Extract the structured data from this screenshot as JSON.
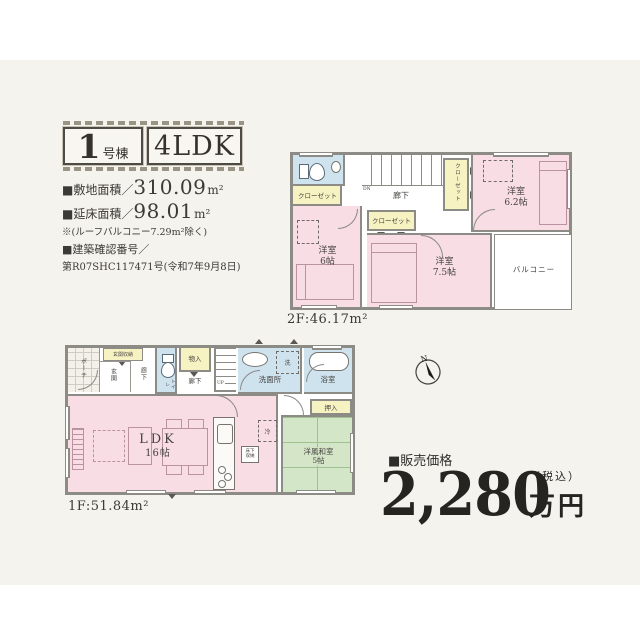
{
  "header": {
    "unit_big": "1",
    "unit_small": "号棟",
    "plan": "4LDK"
  },
  "specs": {
    "site_label": "■敷地面積／",
    "site_value": "310.09",
    "site_unit": "m²",
    "bldg_label": "■延床面積／",
    "bldg_value": "98.01",
    "bldg_unit": "m²",
    "note": "※(ルーフバルコニー7.29m²除く)",
    "permit_label": "■建築確認番号／",
    "permit_number": "第R07SHC117471号(令和7年9月8日)"
  },
  "floor2": {
    "area": "2F:46.17m²",
    "hallway": "廊下",
    "stairs": "DN",
    "closet_left": "クローゼット",
    "closet_mid": "クローゼット",
    "closet_right": "クローゼット",
    "room6_name": "洋室",
    "room6_size": "6帖",
    "room75_name": "洋室",
    "room75_size": "7.5帖",
    "room62_name": "洋室",
    "room62_size": "6.2帖",
    "balcony": "バルコニー"
  },
  "floor1": {
    "area": "1F:51.84m²",
    "porch": "ポーチ",
    "shoe": "玄関収納",
    "entrance": "玄関",
    "hall_front": "廊下",
    "toilet": "トイレ",
    "storage": "物入",
    "hallway": "廊下",
    "stairs": "UP",
    "washroom": "洗面所",
    "washer": "洗",
    "bath": "浴室",
    "ldk_name": "LDK",
    "ldk_size": "16帖",
    "underfloor": "床下収納",
    "fridge": "冷",
    "oshiire": "押入",
    "washitsu_name": "洋風和室",
    "washitsu_size": "5帖"
  },
  "compass": {
    "n": "N"
  },
  "price": {
    "label": "■販売価格",
    "amount": "2,280",
    "tax": "（税込）",
    "unit": "万円"
  },
  "colors": {
    "pink": "#f8dde4",
    "blue": "#cfe3ee",
    "yellow": "#f6f2c2",
    "tatami": "#d4e6c8",
    "wall": "#8d8b86"
  }
}
